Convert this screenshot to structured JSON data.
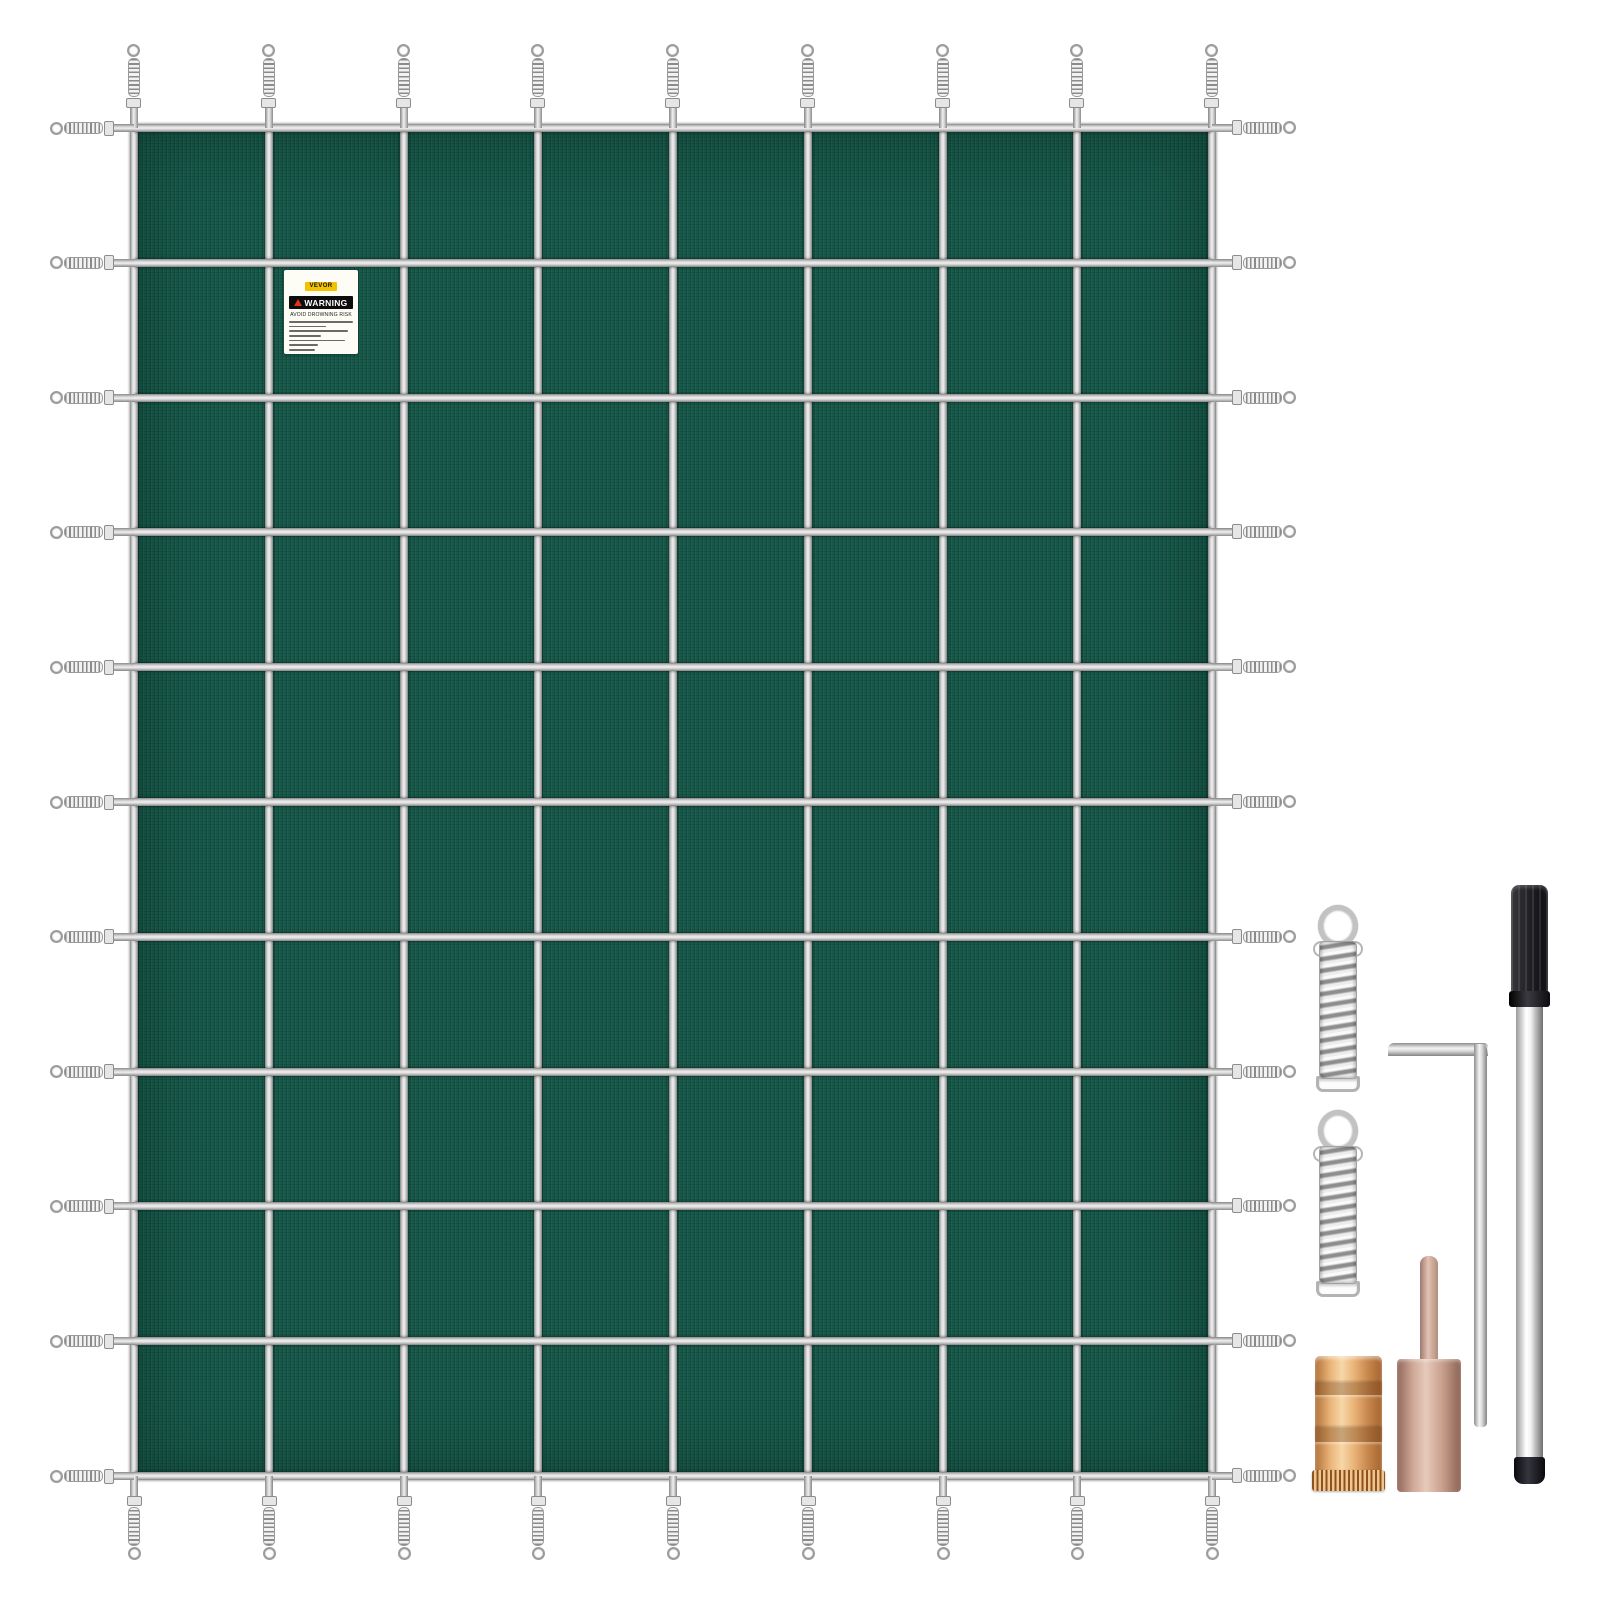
{
  "product": {
    "brand": "VEVOR",
    "description": "green mesh rectangular pool safety cover with strap grid, perimeter tension springs and installation hardware kit"
  },
  "label": {
    "brand": "VEVOR",
    "heading": "WARNING",
    "subheading": "AVOID  DROWNING RISK",
    "fine_print_line_widths_pct": [
      100,
      58,
      92,
      50,
      88,
      46,
      40
    ]
  },
  "cover": {
    "x": 134,
    "y": 128,
    "width": 1078,
    "height": 1348
  },
  "grid": {
    "vertical_straps": 9,
    "horizontal_straps": 11,
    "columns": 8,
    "rows": 10,
    "perimeter_springs": 40
  },
  "accessories": [
    {
      "name": "tension-spring",
      "count": 2
    },
    {
      "name": "hex-key",
      "count": 1
    },
    {
      "name": "installation-rod",
      "count": 1
    },
    {
      "name": "brass-anchor",
      "count": 1
    },
    {
      "name": "copper-anchor-with-pin",
      "count": 1
    }
  ],
  "colors": {
    "background": "#ffffff",
    "mesh_green": "#175a4b",
    "strap_silver": "#d9d9d9",
    "spring_steel": "#c2c2c2",
    "label_yellow": "#f2c200",
    "warning_black": "#0d0d0d",
    "warning_triangle_red": "#e03418",
    "handle_black": "#1b1b20",
    "chrome": "#f2f2f2",
    "brass": "#e9b276",
    "copper_rose": "#cfa898"
  }
}
